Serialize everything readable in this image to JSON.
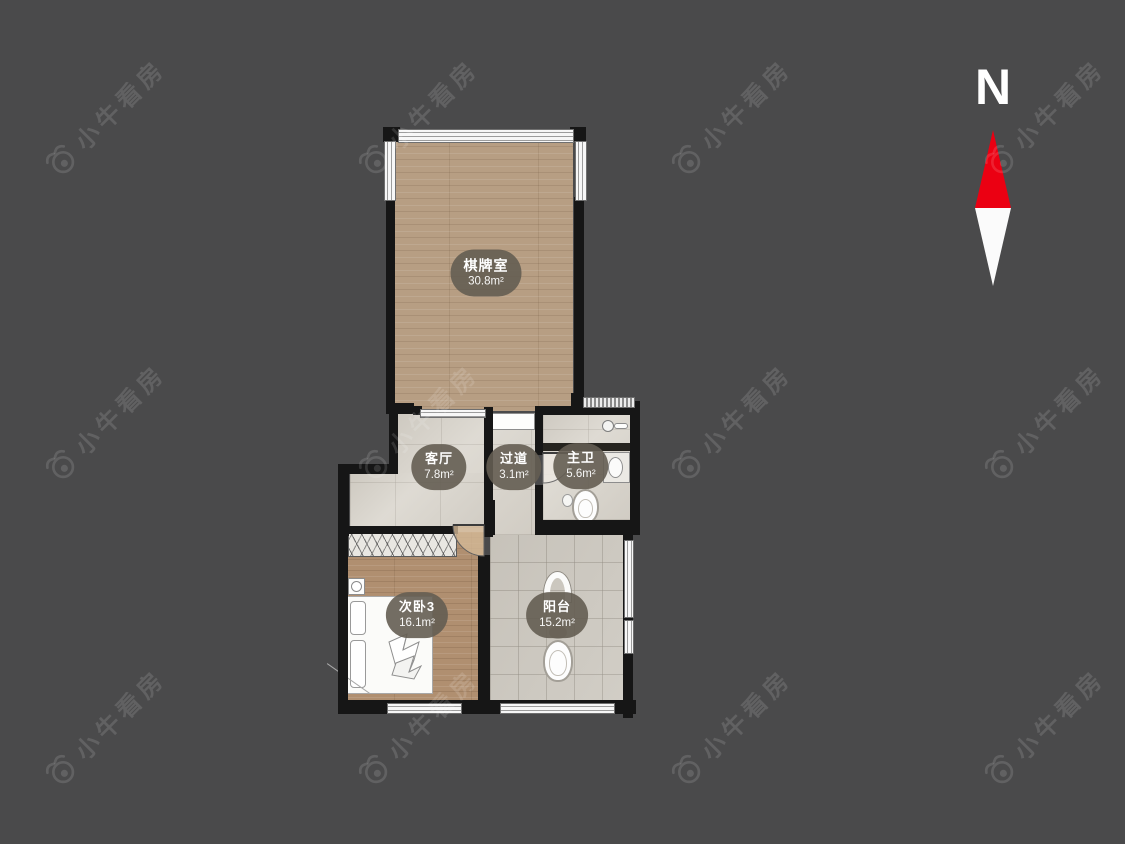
{
  "background": "#4a4a4b",
  "palette": {
    "wall": "#161616",
    "wood_floor": "#b79e83",
    "bedroom_floor": "#b08f70",
    "tile_floor": "#d6d2ca",
    "balcony_tile": "#cbc7bf",
    "label_bubble": "rgba(100,93,82,0.9)",
    "wm_color": "rgba(255,255,255,0.13)"
  },
  "watermark": {
    "text": "小牛看房",
    "grid": {
      "cols": [
        105,
        418,
        731,
        1044
      ],
      "rows": [
        117,
        422,
        727
      ]
    }
  },
  "compass": {
    "label": "N",
    "needle_red": "#eb0012",
    "needle_white": "#fbfbfb"
  },
  "rooms": [
    {
      "name": "棋牌室",
      "area": "30.8m²"
    },
    {
      "name": "客厅",
      "area": "7.8m²"
    },
    {
      "name": "过道",
      "area": "3.1m²"
    },
    {
      "name": "主卫",
      "area": "5.6m²"
    },
    {
      "name": "次卧3",
      "area": "16.1m²"
    },
    {
      "name": "阳台",
      "area": "15.2m²"
    }
  ]
}
